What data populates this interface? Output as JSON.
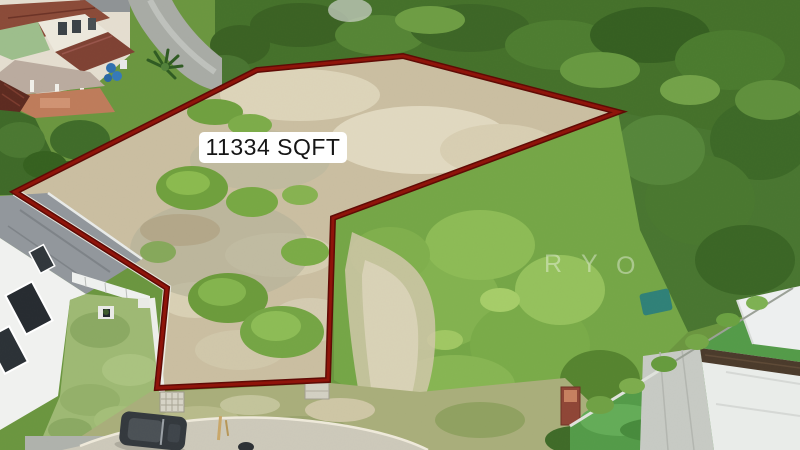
{
  "image": {
    "kind": "aerial-drone-photo",
    "subject": "vacant land plot outlined for sale, surrounded by houses, road and trees",
    "width": 800,
    "height": 450
  },
  "annotation": {
    "area_label": "11334 SQFT",
    "label_bg_color": "#ffffff",
    "label_text_color": "#151515",
    "boundary_points": "15,192 257,70 403,56 618,112 333,218 328,380 157,388 167,288",
    "boundary_color_outer": "#5e0a05",
    "boundary_color_inner": "#8e130a"
  },
  "watermark": {
    "letters": [
      "R",
      "Y",
      "O"
    ],
    "color": "#ffffff"
  },
  "scene": {
    "palette": {
      "plot_ground": "#c9bda0",
      "trees_dark": "#44702a",
      "shrubs_bright": "#74a546",
      "lawn": "#9db873",
      "road": "#ccc8b9",
      "terracotta_roof": "#8a4a38",
      "white_house": "#f0f1ef",
      "car": "#33383d",
      "teal_canopy": "#2f8077",
      "brick_pillar": "#8e4536"
    },
    "elements": [
      "terrace-houses",
      "street",
      "palm-tree",
      "white-house",
      "lawn",
      "parked-car",
      "cul-de-sac-road",
      "vacant-plot",
      "boundary-wall",
      "modern-house",
      "teal-canopy",
      "brick-pillar",
      "dense-trees"
    ]
  }
}
